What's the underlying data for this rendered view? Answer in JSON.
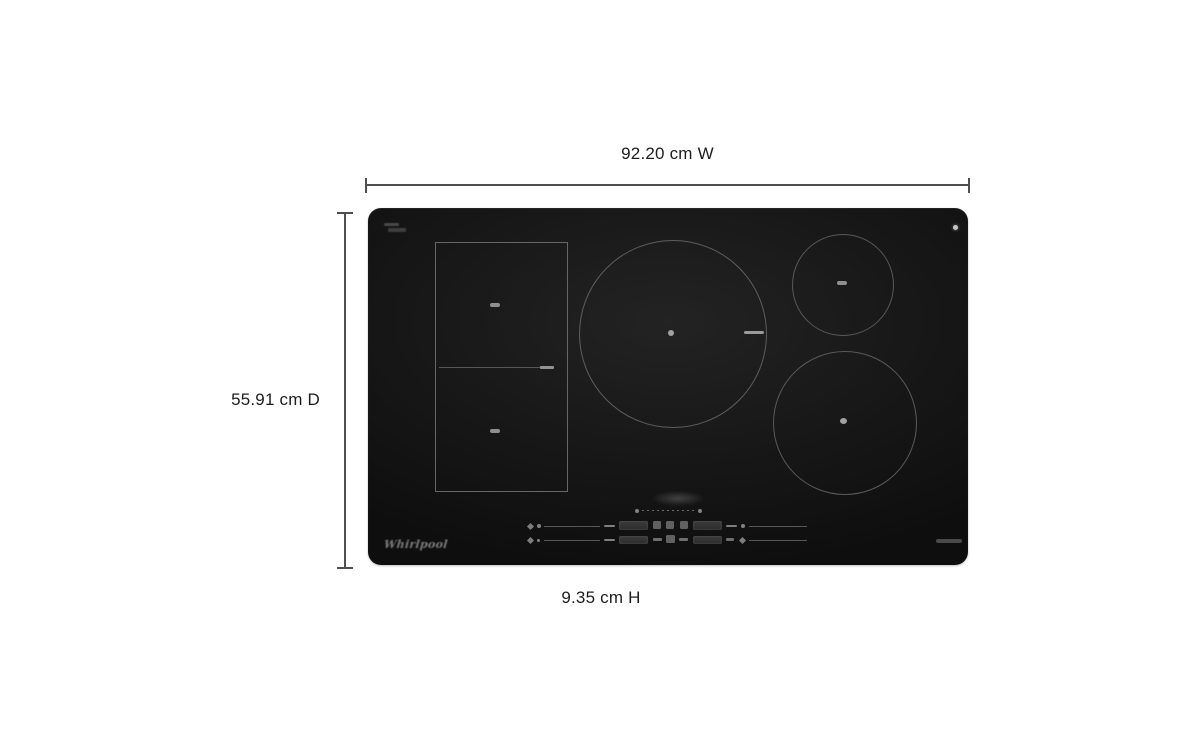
{
  "dimensions": {
    "width": {
      "label": "92.20 cm W"
    },
    "depth": {
      "label": "55.91 cm D"
    },
    "height": {
      "label": "9.35 cm H"
    }
  },
  "product": {
    "brand": "Whirlpool",
    "type_hint": "induction cooktop",
    "zones": [
      {
        "name": "flex-zone-upper-left",
        "shape": "square"
      },
      {
        "name": "flex-zone-lower-left",
        "shape": "square"
      },
      {
        "name": "center-large-burner",
        "shape": "circle"
      },
      {
        "name": "upper-right-burner",
        "shape": "circle"
      },
      {
        "name": "lower-right-burner",
        "shape": "circle"
      }
    ]
  },
  "colors": {
    "background": "#ffffff",
    "cooktop_surface": "#161616",
    "burner_ring": "#5e5e5e",
    "dimension_line": "#4f4f4f",
    "label_text": "#1d1d1d"
  }
}
